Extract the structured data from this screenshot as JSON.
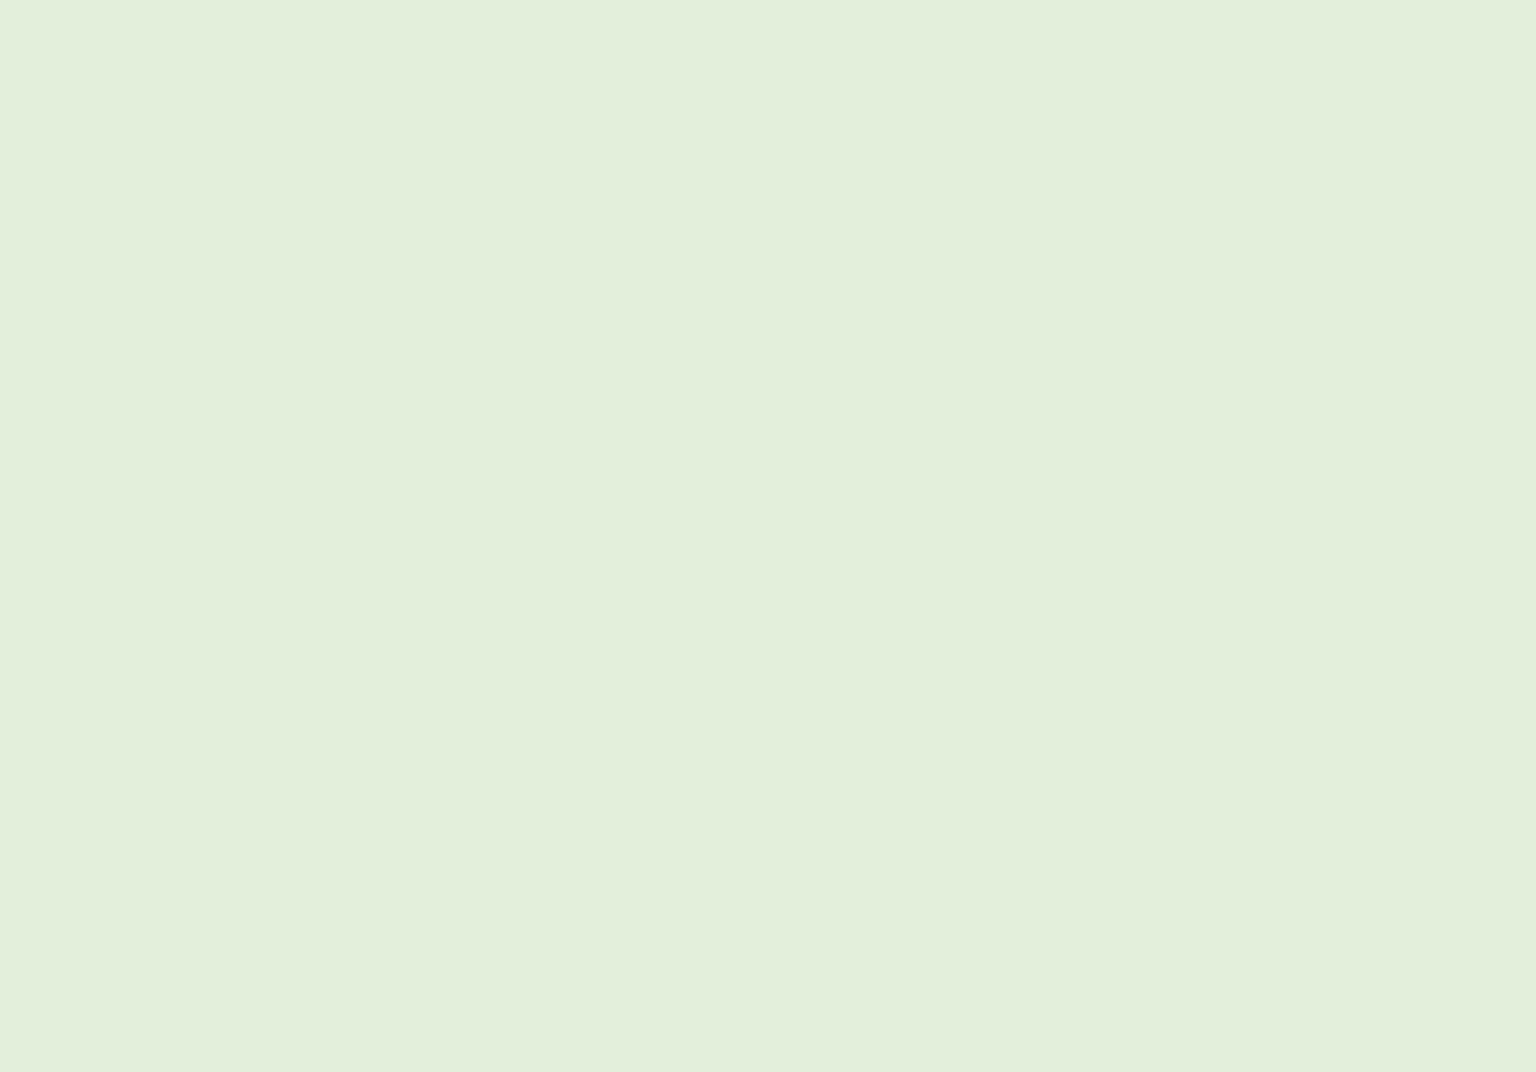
{
  "scene_type": "architectural-3d-site-plan-rendering",
  "colors": {
    "ground": "#e3eedb",
    "groundLight": "#eef5e7",
    "terrace": "#d0e0bc",
    "terraceDark": "#b9cfa0",
    "field": "#b7cba2",
    "contour": "#8f9c85",
    "contourIndex": "#2f352b",
    "road": "#8c8c8c",
    "pad": "#d8d8d2",
    "white": "#fbfbfb",
    "whiteShade": "#ececea",
    "whiteWall": "#dddddc",
    "whiteWallDark": "#c9c9c7",
    "outline": "#5f5f5f",
    "devRoof": "#9b918b",
    "devRoofDark": "#847a74",
    "devWallFront": "#7c706a",
    "devWallSide": "#675c57",
    "devBase": "#e8e7e3",
    "window": "#2d9fd6",
    "frame": "#22313b",
    "stair": "#3d3d3d",
    "chimney": "#a8a8a6",
    "chimneySide": "#8a8a88",
    "treeDark": "#7f9d63",
    "treeLight": "#9cba7e",
    "treeOutline": "#43523a",
    "trunk": "#2f3529",
    "treeGround": "#b4d88b",
    "pathYellow": "#e9e08e",
    "carBody": "#9c2127",
    "carWindow": "#3aa5d8",
    "fence": "#3e4a38",
    "wallWhite": "#f4f4f2",
    "deck": "#f0f0ed",
    "railing": "#8fc3dd"
  },
  "terrain": {
    "patches": [
      {
        "name": "light-meadow-north",
        "fill": "groundLight",
        "opacity": 0.55,
        "pts": "420,60 900,30 1100,120 980,300 640,330 440,200"
      },
      {
        "name": "light-meadow-west",
        "fill": "groundLight",
        "opacity": 0.5,
        "pts": "0,380 180,360 260,430 180,520 0,540"
      },
      {
        "name": "terraced-slope",
        "fill": "terrace",
        "opacity": 1,
        "pts": "150,662 252,616 372,586 470,562 560,588 600,642 560,702 470,762 360,812 250,842 162,822 120,742"
      },
      {
        "name": "dark-bank-a",
        "fill": "terraceDark",
        "opacity": 0.85,
        "pts": "252,560 330,528 428,502 470,520 430,560 330,588"
      },
      {
        "name": "dark-bank-b",
        "fill": "terraceDark",
        "opacity": 0.7,
        "pts": "420,688 500,660 560,676 520,732 448,758"
      },
      {
        "name": "play-field",
        "fill": "field",
        "opacity": 1,
        "pts": "1040,356 1218,398 1228,428 1186,470 1085,468 1008,428"
      }
    ],
    "slope_arcs": [
      "M180,650 C280,610 390,585 480,580",
      "M165,690 C270,650 390,620 500,615",
      "M158,730 C270,690 400,655 520,650",
      "M168,772 C280,732 410,695 540,690",
      "M192,810 C300,772 420,738 548,730"
    ]
  },
  "contours": {
    "minor": [
      "M0,150 C120,128 260,104 420,60 S620,18 760,22",
      "M0,208 C140,182 300,150 460,98 S640,48 780,52",
      "M0,268 C150,244 320,204 490,140 S700,78 860,80",
      "M0,330 C160,306 330,270 520,196 S760,120 930,126",
      "M60,392 C220,368 400,330 580,250 S820,160 1000,170",
      "M520,52 C610,30 700,22 780,26",
      "M610,80 C700,60 790,55 870,60",
      "M905,175 C1100,130 1300,70 1460,30",
      "M960,205 C1160,158 1360,100 1536,62",
      "M1035,262 C1235,215 1430,160 1536,118",
      "M1080,300 C1280,255 1470,200 1536,172",
      "M1130,342 C1320,300 1480,252 1536,232",
      "M1190,382 C1360,344 1480,306 1536,290",
      "M1255,420 C1390,388 1480,360 1536,348",
      "M390,300 C520,270 640,258 760,268",
      "M300,372 C440,340 560,330 660,338",
      "M170,452 C320,420 440,408 540,416",
      "M90,520 C240,488 360,476 450,484",
      "M0,848 C120,828 260,824 380,846 S560,900 640,946",
      "M0,902 C110,886 230,884 330,902",
      "M60,955 C160,940 240,942 300,958",
      "M700,660 C800,640 900,625 1000,612",
      "M760,700 C880,678 990,660 1090,648",
      "M820,745 C940,722 1060,700 1160,690",
      "M880,790 C1000,768 1120,742 1210,730",
      "M1352,470 C1430,448 1500,436 1536,432",
      "M1360,515 C1440,494 1505,482 1536,478"
    ],
    "index": [
      "M0,96 C100,80 220,72 320,62 S460,16 560,2",
      "M830,240 C1060,208 1300,165 1536,126",
      "M996,516 C968,560 930,600 870,640 S700,688 560,702 S380,742 290,806",
      "M330,992 C520,958 700,932 845,918",
      "M1448,352 C1360,390 1318,420 1322,500 S1350,640 1352,700 S1330,800 1305,852",
      "M0,916 C40,918 70,940 80,964"
    ]
  },
  "roads": {
    "pool": {
      "name": "road-junction-east",
      "pts": "1390,560 1452,520 1536,498 1536,700 1470,695 1420,650"
    },
    "peninsula": {
      "name": "green-peninsula",
      "pts": "1434,652 1458,590 1495,556 1536,548 1536,662 1492,688 1452,686"
    },
    "peninsula_contours": [
      "M1460,600 C1492,586 1518,580 1536,578",
      "M1452,642 C1490,626 1518,620 1536,618"
    ],
    "strokes": [
      {
        "name": "road-east",
        "d": "M1000,866 C1120,830 1220,790 1268,742 C1310,700 1318,640 1322,560 C1326,498 1332,462 1368,430 C1410,396 1480,348 1536,330",
        "w": 46
      },
      {
        "name": "road-south",
        "d": "M0,1016 C220,1000 440,972 640,948 C760,934 900,894 1010,862",
        "w": 62
      },
      {
        "name": "driveway-upper",
        "d": "M1064,344 C1160,388 1250,420 1322,448",
        "w": 17
      },
      {
        "name": "driveway-loop",
        "d": "M1300,468 C1220,462 1150,448 1095,444 C1030,440 1000,470 1006,502 C1012,530 1050,542 1085,532 C1110,524 1114,500 1096,486",
        "w": 26
      }
    ],
    "polygons": [
      {
        "name": "road-corner-ne",
        "pts": "1352,0 1428,0 1536,84 1536,130"
      },
      {
        "name": "road-edge-west",
        "pts": "0,748 54,774 0,828"
      },
      {
        "name": "road-branch",
        "pts": "448,846 518,846 648,948 568,968"
      }
    ],
    "island": {
      "name": "turning-island",
      "cx": 1058,
      "cy": 494,
      "rx": 20,
      "ry": 11,
      "fill": "terrace"
    }
  },
  "lines": {
    "powerlines": [
      "M558,332 L762,366 L1042,430",
      "M584,322 L786,354 L1062,420"
    ],
    "field_fence": {
      "d": "M1008,432 L1192,472",
      "stroke": "fence",
      "w": 2.2
    },
    "field_wall": {
      "d": "M1056,360 C1150,404 1245,434 1318,456",
      "stroke": "wallWhite",
      "w": 4
    },
    "yellow_paths": [
      "M636,601 C700,584 762,574 820,600 C858,618 880,612 904,580 C926,551 956,548 986,560 C1000,566 1012,560 1022,548",
      "M956,549 C988,574 1020,584 1058,584",
      "M1062,468 L1088,480"
    ],
    "pads": [
      {
        "name": "parking-pad",
        "pts": "1092,452 1205,452 1238,506 1108,514"
      },
      {
        "name": "courtyard-pad",
        "pts": "615,560 700,538 762,558 742,602 648,612"
      }
    ],
    "play_circle": {
      "cx": 637,
      "cy": 581,
      "r": 8
    },
    "play_equipment": [
      "M664,566 L700,580",
      "M668,578 L696,564"
    ]
  },
  "context_buildings_back": [
    {
      "name": "slab-house-nw-1",
      "kind": "box",
      "x": 0,
      "y": 128,
      "l": 150,
      "w": 46,
      "h": 34,
      "dir": "b"
    },
    {
      "name": "slab-house-nw-2",
      "kind": "box",
      "x": 8,
      "y": 198,
      "l": 160,
      "w": 46,
      "h": 34,
      "dir": "b"
    },
    {
      "name": "warehouse-nw",
      "kind": "box",
      "x": 170,
      "y": 162,
      "l": 158,
      "w": 60,
      "h": 40,
      "dir": "b"
    },
    {
      "name": "long-box-north",
      "kind": "box",
      "x": 318,
      "y": 148,
      "l": 228,
      "w": 50,
      "h": 44,
      "dir": "b"
    },
    {
      "name": "shed-nw-a",
      "kind": "box",
      "x": 253,
      "y": 228,
      "l": 44,
      "w": 26,
      "h": 18,
      "dir": "a"
    },
    {
      "name": "shed-nw-b",
      "kind": "box",
      "x": 494,
      "y": 194,
      "l": 38,
      "w": 22,
      "h": 16,
      "dir": "a"
    },
    {
      "name": "gable-house-nw",
      "kind": "gable",
      "x": 385,
      "y": 258,
      "l": 92,
      "w": 56,
      "g": 22,
      "dir": "a"
    },
    {
      "name": "cross-gable-north",
      "kind": "hip",
      "x": 570,
      "y": 182,
      "l": 128,
      "w": 60,
      "g": 24,
      "dir": "a"
    },
    {
      "name": "shed-north",
      "kind": "gable",
      "x": 742,
      "y": 66,
      "l": 58,
      "w": 30,
      "g": 14,
      "dir": "a"
    },
    {
      "name": "big-house-north",
      "kind": "gable",
      "x": 858,
      "y": 6,
      "l": 116,
      "w": 64,
      "g": 30,
      "dir": "a"
    },
    {
      "name": "hall-north",
      "kind": "hip",
      "x": 900,
      "y": 90,
      "l": 190,
      "w": 70,
      "g": 28,
      "dir": "a"
    },
    {
      "name": "box-north",
      "kind": "box",
      "x": 995,
      "y": 2,
      "l": 80,
      "w": 34,
      "h": 26,
      "dir": "a"
    },
    {
      "name": "complex-house-ne",
      "kind": "hip",
      "x": 1188,
      "y": 26,
      "l": 74,
      "w": 60,
      "g": 36,
      "dir": "a"
    },
    {
      "name": "annex-ne",
      "kind": "box",
      "x": 1243,
      "y": 62,
      "l": 40,
      "w": 22,
      "h": 18,
      "dir": "a"
    },
    {
      "name": "gable-ne",
      "kind": "gable",
      "x": 1344,
      "y": 20,
      "l": 48,
      "w": 34,
      "g": 16,
      "dir": "a"
    },
    {
      "name": "slab-ne-corner",
      "kind": "box",
      "x": 1402,
      "y": 0,
      "l": 130,
      "w": 40,
      "h": 30,
      "dir": "a"
    },
    {
      "name": "gable-east-a",
      "kind": "gable",
      "x": 1302,
      "y": 232,
      "l": 120,
      "w": 62,
      "g": 30,
      "dir": "a"
    },
    {
      "name": "gable-east-b",
      "kind": "gable",
      "x": 1478,
      "y": 240,
      "l": 58,
      "w": 50,
      "g": 26,
      "dir": "a"
    },
    {
      "name": "hip-shed-east",
      "kind": "hip",
      "x": 1355,
      "y": 308,
      "l": 54,
      "w": 40,
      "g": 14,
      "dir": "a"
    },
    {
      "name": "villa-east",
      "kind": "hip",
      "x": 1340,
      "y": 388,
      "l": 100,
      "w": 80,
      "g": 40,
      "dir": "a"
    },
    {
      "name": "villa-annex-east",
      "kind": "box",
      "x": 1448,
      "y": 430,
      "l": 46,
      "w": 30,
      "h": 56,
      "dir": "a"
    },
    {
      "name": "shed-east",
      "kind": "box",
      "x": 1415,
      "y": 470,
      "l": 30,
      "w": 20,
      "h": 22,
      "dir": "a"
    },
    {
      "name": "gable-sw-edge",
      "kind": "gable",
      "x": 6,
      "y": 712,
      "l": 52,
      "w": 40,
      "g": 30,
      "dir": "a"
    },
    {
      "name": "villa-sw",
      "kind": "hip",
      "x": 160,
      "y": 772,
      "l": 140,
      "w": 80,
      "g": 38,
      "dir": "a"
    },
    {
      "name": "gable-sw-b",
      "kind": "gable",
      "x": 40,
      "y": 806,
      "l": 68,
      "w": 40,
      "g": 26,
      "dir": "a"
    },
    {
      "name": "hip-house-sw",
      "kind": "hip",
      "x": 360,
      "y": 884,
      "l": 88,
      "w": 60,
      "g": 30,
      "dir": "a"
    },
    {
      "name": "shed-sw",
      "kind": "box",
      "x": 256,
      "y": 940,
      "l": 52,
      "w": 30,
      "h": 24,
      "dir": "a"
    },
    {
      "name": "gable-sw-edge-2",
      "kind": "gable",
      "x": 0,
      "y": 940,
      "l": 42,
      "w": 40,
      "g": 30,
      "dir": "a"
    },
    {
      "name": "gable-south-a",
      "kind": "gable",
      "x": 640,
      "y": 716,
      "l": 112,
      "w": 62,
      "g": 36,
      "dir": "a"
    },
    {
      "name": "gable-south-small",
      "kind": "gable",
      "x": 470,
      "y": 806,
      "l": 52,
      "w": 36,
      "g": 26,
      "dir": "a"
    },
    {
      "name": "gable-south-b",
      "kind": "gable",
      "x": 718,
      "y": 840,
      "l": 84,
      "w": 48,
      "g": 28,
      "dir": "a"
    },
    {
      "name": "gable-south-c",
      "kind": "gable",
      "x": 880,
      "y": 712,
      "l": 106,
      "w": 58,
      "g": 34,
      "dir": "a"
    },
    {
      "name": "gable-se",
      "kind": "gable",
      "x": 1015,
      "y": 852,
      "l": 115,
      "w": 55,
      "g": 32,
      "dir": "b"
    },
    {
      "name": "cross-gable-se",
      "kind": "hip",
      "x": 1112,
      "y": 740,
      "l": 68,
      "w": 48,
      "g": 30,
      "dir": "a"
    },
    {
      "name": "box-se",
      "kind": "box",
      "x": 1188,
      "y": 668,
      "l": 30,
      "w": 18,
      "h": 20,
      "dir": "a"
    },
    {
      "name": "shed-mid-a",
      "kind": "hip",
      "x": 852,
      "y": 614,
      "l": 40,
      "w": 30,
      "g": 16,
      "dir": "a"
    },
    {
      "name": "shed-mid-b",
      "kind": "box",
      "x": 914,
      "y": 626,
      "l": 24,
      "w": 14,
      "h": 14,
      "dir": "a"
    }
  ],
  "masses": {
    "polys": [
      {
        "name": "white-mass-a",
        "pts": "838,1072 1008,980 1168,940 1098,1022 962,1072"
      },
      {
        "name": "white-mass-b",
        "pts": "962,1072 1168,940 1335,888 1536,842 1536,1072"
      }
    ],
    "shade": {
      "name": "white-mass-shade",
      "pts": "1168,940 1335,888 1268,962 1150,1002"
    },
    "facets": [
      [
        1168,
        940,
        1296,
        1002
      ],
      [
        1296,
        1002,
        1536,
        904
      ],
      [
        1098,
        1022,
        1296,
        1002
      ],
      [
        1335,
        888,
        1296,
        1002
      ]
    ]
  },
  "context_buildings_front": [
    {
      "name": "gable-br",
      "kind": "gable",
      "x": 1246,
      "y": 884,
      "l": 116,
      "w": 58,
      "g": 26,
      "dir": "a"
    },
    {
      "name": "shed-br",
      "kind": "box",
      "x": 1238,
      "y": 836,
      "l": 26,
      "w": 16,
      "h": 16,
      "dir": "a"
    },
    {
      "name": "wall-slab-br",
      "kind": "box",
      "x": 1088,
      "y": 942,
      "l": 44,
      "w": 10,
      "h": 14,
      "dir": "a"
    },
    {
      "name": "box-right-edge",
      "kind": "box",
      "x": 1476,
      "y": 758,
      "l": 30,
      "w": 18,
      "h": 14,
      "dir": "a"
    },
    {
      "name": "gable-right-edge",
      "kind": "gable",
      "x": 1508,
      "y": 777,
      "l": 26,
      "w": 22,
      "g": 12,
      "dir": "a"
    }
  ],
  "development": {
    "rows": [
      {
        "name": "townhouse-row-4",
        "x": 830,
        "y": 373,
        "n": 3
      },
      {
        "name": "townhouse-row-3",
        "x": 640,
        "y": 434,
        "n": 3
      },
      {
        "name": "townhouse-row-2",
        "x": 462,
        "y": 505,
        "n": 3
      },
      {
        "name": "townhouse-row-1",
        "x": 318,
        "y": 600,
        "n": 2
      }
    ],
    "cluster": [
      {
        "name": "cluster-house-1",
        "x": 1152,
        "y": 408,
        "l": 66,
        "w": 34,
        "g": 44
      },
      {
        "name": "cluster-house-2",
        "x": 1224,
        "y": 450,
        "l": 66,
        "w": 34,
        "g": 44
      },
      {
        "name": "cluster-house-3",
        "x": 1164,
        "y": 482,
        "l": 72,
        "w": 38,
        "g": 56
      },
      {
        "name": "cluster-house-4",
        "x": 1247,
        "y": 494,
        "l": 72,
        "w": 38,
        "g": 56
      }
    ],
    "deck": {
      "pts": "1150,548 1232,566 1232,580 1150,562",
      "rail": [
        1150,
        544,
        1232,
        562
      ],
      "stair": "1234,536 1256,542 1250,586 1230,578"
    }
  },
  "trees": {
    "back": [
      [
        648,
        397,
        1.0
      ],
      [
        700,
        410,
        1.0
      ],
      [
        748,
        428,
        0.95
      ],
      [
        525,
        470,
        0.85
      ],
      [
        572,
        490,
        0.8
      ],
      [
        1310,
        482,
        0.8
      ]
    ],
    "front": [
      [
        538,
        648,
        1.15
      ],
      [
        580,
        662,
        1.1
      ],
      [
        620,
        670,
        1.0
      ],
      [
        658,
        656,
        0.95
      ],
      [
        600,
        702,
        0.95
      ],
      [
        540,
        708,
        0.9
      ],
      [
        684,
        642,
        0.9
      ],
      [
        552,
        746,
        1.0
      ],
      [
        935,
        550,
        1.0
      ],
      [
        1002,
        543,
        1.05
      ],
      [
        996,
        684,
        1.0
      ],
      [
        958,
        850,
        1.1
      ],
      [
        1014,
        562,
        0.8
      ],
      [
        1046,
        574,
        0.75
      ],
      [
        1300,
        642,
        0.9
      ],
      [
        1320,
        694,
        0.85
      ],
      [
        1242,
        650,
        0.8
      ],
      [
        1262,
        602,
        0.7
      ]
    ]
  },
  "cars": [
    {
      "name": "parked-suv",
      "x": 1150,
      "y": 468,
      "rot": -10,
      "s": 1.05
    },
    {
      "name": "parked-car-1",
      "x": 1020,
      "y": 496,
      "rot": -16,
      "s": 1.0
    },
    {
      "name": "parked-car-2",
      "x": 1032,
      "y": 514,
      "rot": -16,
      "s": 1.0
    }
  ]
}
